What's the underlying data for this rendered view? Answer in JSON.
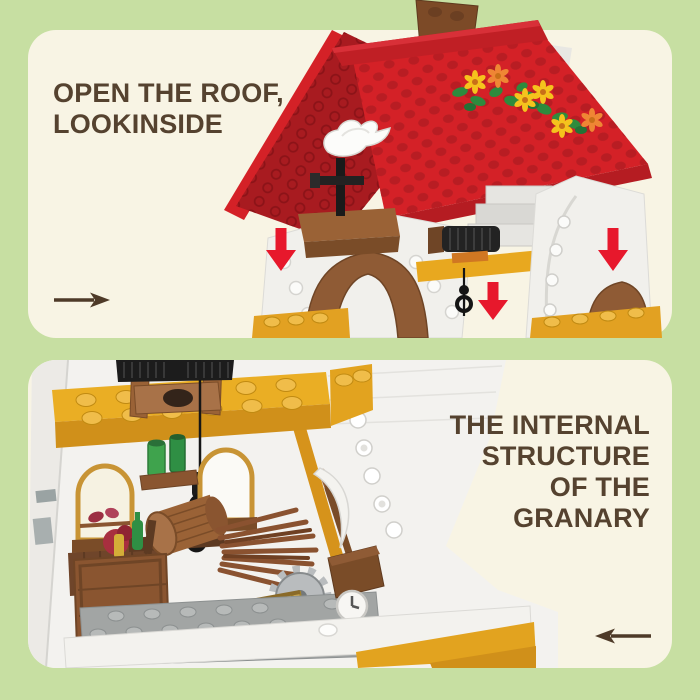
{
  "page": {
    "background_color": "#c7dfa2"
  },
  "top_panel": {
    "heading": {
      "line1": "OPEN THE ROOF,",
      "line2": "LOOKINSIDE"
    },
    "nav_arrow_direction": "right",
    "photo": {
      "subject": "brick-built granary with red stud roof lifted open",
      "down_arrow_count": 3,
      "elements": "red roof with flower vine, brown chimney, white dove on mast, white gable walls, brown arch brackets, black winch, gold ledges"
    }
  },
  "bottom_panel": {
    "heading": {
      "line1": "THE INTERNAL",
      "line2": "STRUCTURE",
      "line3": "OF THE",
      "line4": "GRANARY"
    },
    "nav_arrow_direction": "left",
    "photo": {
      "subject": "interior of the granary",
      "elements": "gold stud beam, well hoist with rope and hook, arched windows, shelf with green jars, wooden barrel, pole bundle, food crate, gray stud floor, scythe, gear, woven basket"
    }
  },
  "colors": {
    "page_bg": "#c7dfa2",
    "panel_bg": "#f8f4e4",
    "heading_text": "#55422f",
    "nav_arrow": "#4e3a28",
    "highlight_arrow_red": "#e7182c",
    "roof_red": "#d42127",
    "roof_red_dark": "#a81b20",
    "brick_gold": "#e8a81f",
    "wood_brown": "#8f5b35",
    "leaf_green": "#2e8b3d",
    "plate_gray": "#a2a5a4"
  }
}
